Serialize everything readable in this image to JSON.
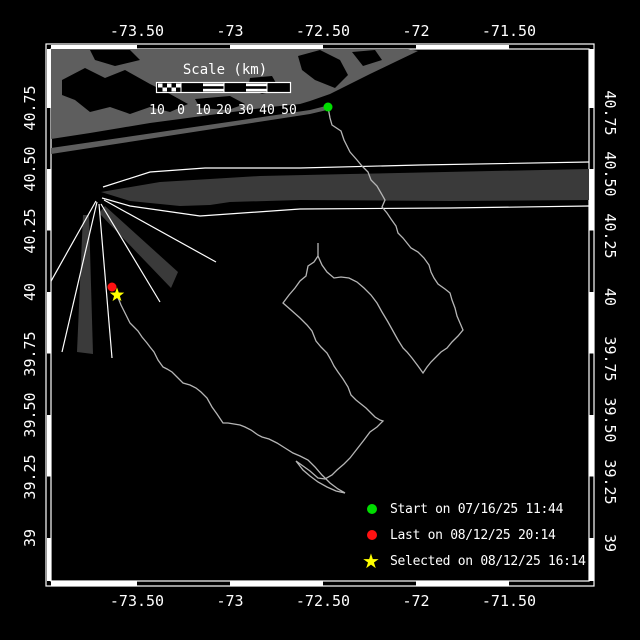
{
  "axes": {
    "top": [
      "-73.50",
      "-73",
      "-72.50",
      "-72",
      "-71.50"
    ],
    "bottom": [
      "-73.50",
      "-73",
      "-72.50",
      "-72",
      "-71.50"
    ],
    "left": [
      "40.75",
      "40.50",
      "40.25",
      "40",
      "39.75",
      "39.50",
      "39.25",
      "39"
    ],
    "right": [
      "40.75",
      "40.50",
      "40.25",
      "40",
      "39.75",
      "39.50",
      "39.25",
      "39"
    ]
  },
  "scale_bar": {
    "title": "Scale (km)",
    "tick_labels": [
      "10",
      "0",
      "10",
      "20",
      "30",
      "40",
      "50"
    ]
  },
  "legend": {
    "items": [
      {
        "marker": "start-dot",
        "glyph": "●",
        "color": "#00dd00",
        "label": "Start on 07/16/25 11:44"
      },
      {
        "marker": "last-dot",
        "glyph": "●",
        "color": "#ff1111",
        "label": "Last on 08/12/25 20:14"
      },
      {
        "marker": "selected-star",
        "glyph": "★",
        "color": "#ffff00",
        "label": "Selected on 08/12/25 16:14"
      }
    ]
  },
  "colors": {
    "background": "#000000",
    "land": "#5e5e5e",
    "shipping_lane": "#3a3a3a",
    "track": "#b5b5b5",
    "frame": "#ffffff",
    "start_marker": "#00dd00",
    "last_marker": "#ff1111",
    "selected_marker": "#ffff00"
  },
  "map": {
    "markers": [
      {
        "name": "start",
        "shape": "circle",
        "x": 328,
        "y": 107,
        "r": 4.5,
        "color": "#00dd00"
      },
      {
        "name": "last",
        "shape": "circle",
        "x": 112,
        "y": 287,
        "r": 4.5,
        "color": "#ff1111"
      },
      {
        "name": "selected",
        "shape": "star",
        "x": 117,
        "y": 295,
        "r": 7,
        "color": "#ffff00"
      }
    ],
    "tracks": [
      [
        [
          328,
          107
        ],
        [
          330,
          118
        ],
        [
          332,
          125
        ],
        [
          341,
          131
        ],
        [
          344,
          140
        ],
        [
          350,
          152
        ],
        [
          357,
          160
        ],
        [
          362,
          166
        ],
        [
          368,
          172
        ],
        [
          371,
          180
        ],
        [
          377,
          186
        ],
        [
          381,
          193
        ],
        [
          385,
          200
        ],
        [
          382,
          207
        ],
        [
          387,
          213
        ],
        [
          391,
          219
        ],
        [
          396,
          226
        ],
        [
          398,
          233
        ],
        [
          403,
          238
        ],
        [
          407,
          243
        ],
        [
          411,
          248
        ],
        [
          418,
          252
        ],
        [
          424,
          258
        ],
        [
          429,
          265
        ],
        [
          431,
          272
        ],
        [
          434,
          278
        ],
        [
          438,
          284
        ],
        [
          445,
          289
        ],
        [
          450,
          293
        ],
        [
          452,
          300
        ],
        [
          455,
          308
        ],
        [
          457,
          316
        ],
        [
          460,
          323
        ],
        [
          463,
          330
        ],
        [
          458,
          336
        ],
        [
          452,
          342
        ],
        [
          447,
          348
        ],
        [
          441,
          352
        ],
        [
          436,
          357
        ],
        [
          431,
          362
        ],
        [
          427,
          367
        ],
        [
          423,
          373
        ],
        [
          418,
          366
        ],
        [
          412,
          358
        ],
        [
          407,
          352
        ],
        [
          403,
          348
        ],
        [
          398,
          340
        ],
        [
          393,
          331
        ],
        [
          388,
          322
        ],
        [
          382,
          312
        ],
        [
          377,
          303
        ],
        [
          371,
          295
        ],
        [
          364,
          288
        ],
        [
          357,
          282
        ],
        [
          349,
          278
        ],
        [
          341,
          277
        ],
        [
          334,
          278
        ],
        [
          327,
          272
        ],
        [
          322,
          265
        ],
        [
          318,
          256
        ],
        [
          318,
          243
        ]
      ],
      [
        [
          318,
          256
        ],
        [
          314,
          262
        ],
        [
          308,
          266
        ],
        [
          306,
          276
        ],
        [
          300,
          281
        ],
        [
          295,
          288
        ],
        [
          289,
          295
        ],
        [
          283,
          303
        ],
        [
          291,
          310
        ],
        [
          300,
          318
        ],
        [
          307,
          325
        ],
        [
          312,
          331
        ],
        [
          316,
          341
        ],
        [
          321,
          347
        ],
        [
          327,
          353
        ],
        [
          331,
          360
        ],
        [
          334,
          366
        ],
        [
          338,
          372
        ],
        [
          343,
          379
        ],
        [
          348,
          387
        ],
        [
          351,
          395
        ],
        [
          356,
          400
        ],
        [
          361,
          404
        ],
        [
          366,
          408
        ],
        [
          371,
          413
        ],
        [
          375,
          417
        ],
        [
          380,
          420
        ],
        [
          383,
          421
        ],
        [
          377,
          427
        ],
        [
          370,
          432
        ],
        [
          364,
          440
        ],
        [
          357,
          449
        ],
        [
          350,
          458
        ],
        [
          344,
          464
        ],
        [
          337,
          470
        ],
        [
          332,
          475
        ],
        [
          325,
          479
        ],
        [
          318,
          478
        ],
        [
          310,
          471
        ],
        [
          303,
          466
        ],
        [
          296,
          461
        ],
        [
          303,
          470
        ],
        [
          310,
          476
        ],
        [
          318,
          482
        ],
        [
          327,
          487
        ],
        [
          336,
          491
        ],
        [
          345,
          493
        ]
      ],
      [
        [
          345,
          493
        ],
        [
          338,
          489
        ],
        [
          330,
          483
        ],
        [
          322,
          475
        ],
        [
          315,
          467
        ],
        [
          308,
          460
        ],
        [
          300,
          456
        ],
        [
          293,
          453
        ],
        [
          285,
          448
        ],
        [
          277,
          443
        ],
        [
          269,
          439
        ],
        [
          262,
          437
        ],
        [
          258,
          435
        ],
        [
          251,
          430
        ],
        [
          245,
          427
        ],
        [
          240,
          425
        ],
        [
          234,
          424
        ],
        [
          228,
          423
        ],
        [
          223,
          423
        ],
        [
          217,
          414
        ],
        [
          212,
          407
        ],
        [
          207,
          398
        ],
        [
          201,
          392
        ],
        [
          196,
          388
        ],
        [
          190,
          385
        ],
        [
          183,
          383
        ],
        [
          177,
          377
        ],
        [
          172,
          372
        ],
        [
          167,
          369
        ],
        [
          163,
          367
        ],
        [
          158,
          360
        ],
        [
          154,
          352
        ],
        [
          150,
          347
        ],
        [
          147,
          343
        ],
        [
          142,
          337
        ],
        [
          138,
          331
        ],
        [
          134,
          327
        ],
        [
          130,
          323
        ],
        [
          127,
          317
        ],
        [
          124,
          311
        ],
        [
          121,
          305
        ],
        [
          119,
          300
        ],
        [
          117,
          296
        ]
      ]
    ]
  }
}
